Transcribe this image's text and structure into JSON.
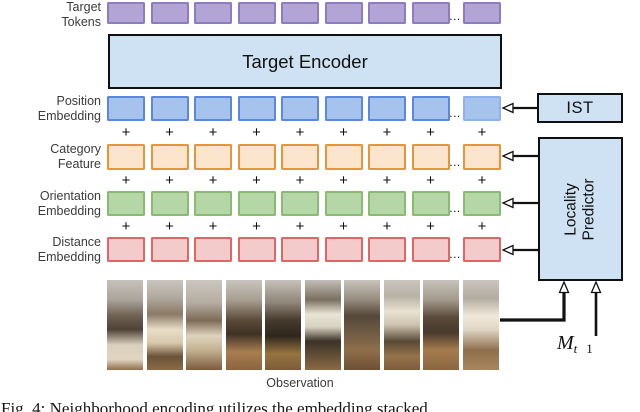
{
  "figure": {
    "row_labels": {
      "target_tokens": {
        "line1": "Target",
        "line2": "Tokens"
      },
      "position": {
        "line1": "Position",
        "line2": "Embedding"
      },
      "category": {
        "line1": "Category",
        "line2": "Feature"
      },
      "orientation": {
        "line1": "Orientation",
        "line2": "Embedding"
      },
      "distance": {
        "line1": "Distance",
        "line2": "Embedding"
      }
    },
    "modules": {
      "target_encoder": "Target Encoder",
      "ist": "IST",
      "locality_predictor": {
        "line1": "Locality",
        "line2": "Predictor"
      }
    },
    "tokens": {
      "visible_count": 8,
      "ellipsis": "...",
      "plus": "+"
    },
    "observation": {
      "label": "Observation",
      "image_count": 10
    },
    "math_label": {
      "base": "M",
      "sub": "t",
      "sub_tail": "1"
    },
    "caption_partial": "Fig. 4:  Neighborhood encoding utilizes the embedding stacked",
    "colors": {
      "target_tokens_fill": "#b3a4d6",
      "target_tokens_border": "#8e7cc3",
      "position_fill": "#a5c3ec",
      "position_border": "#5b88d8",
      "position_final_border": "#8fb2ee",
      "category_fill": "#fce5cd",
      "category_border": "#e6953c",
      "orientation_fill": "#b5d6a7",
      "orientation_border": "#8abb70",
      "distance_fill": "#f3cbca",
      "distance_border": "#e06666",
      "module_fill": "#cfe2f3"
    }
  }
}
